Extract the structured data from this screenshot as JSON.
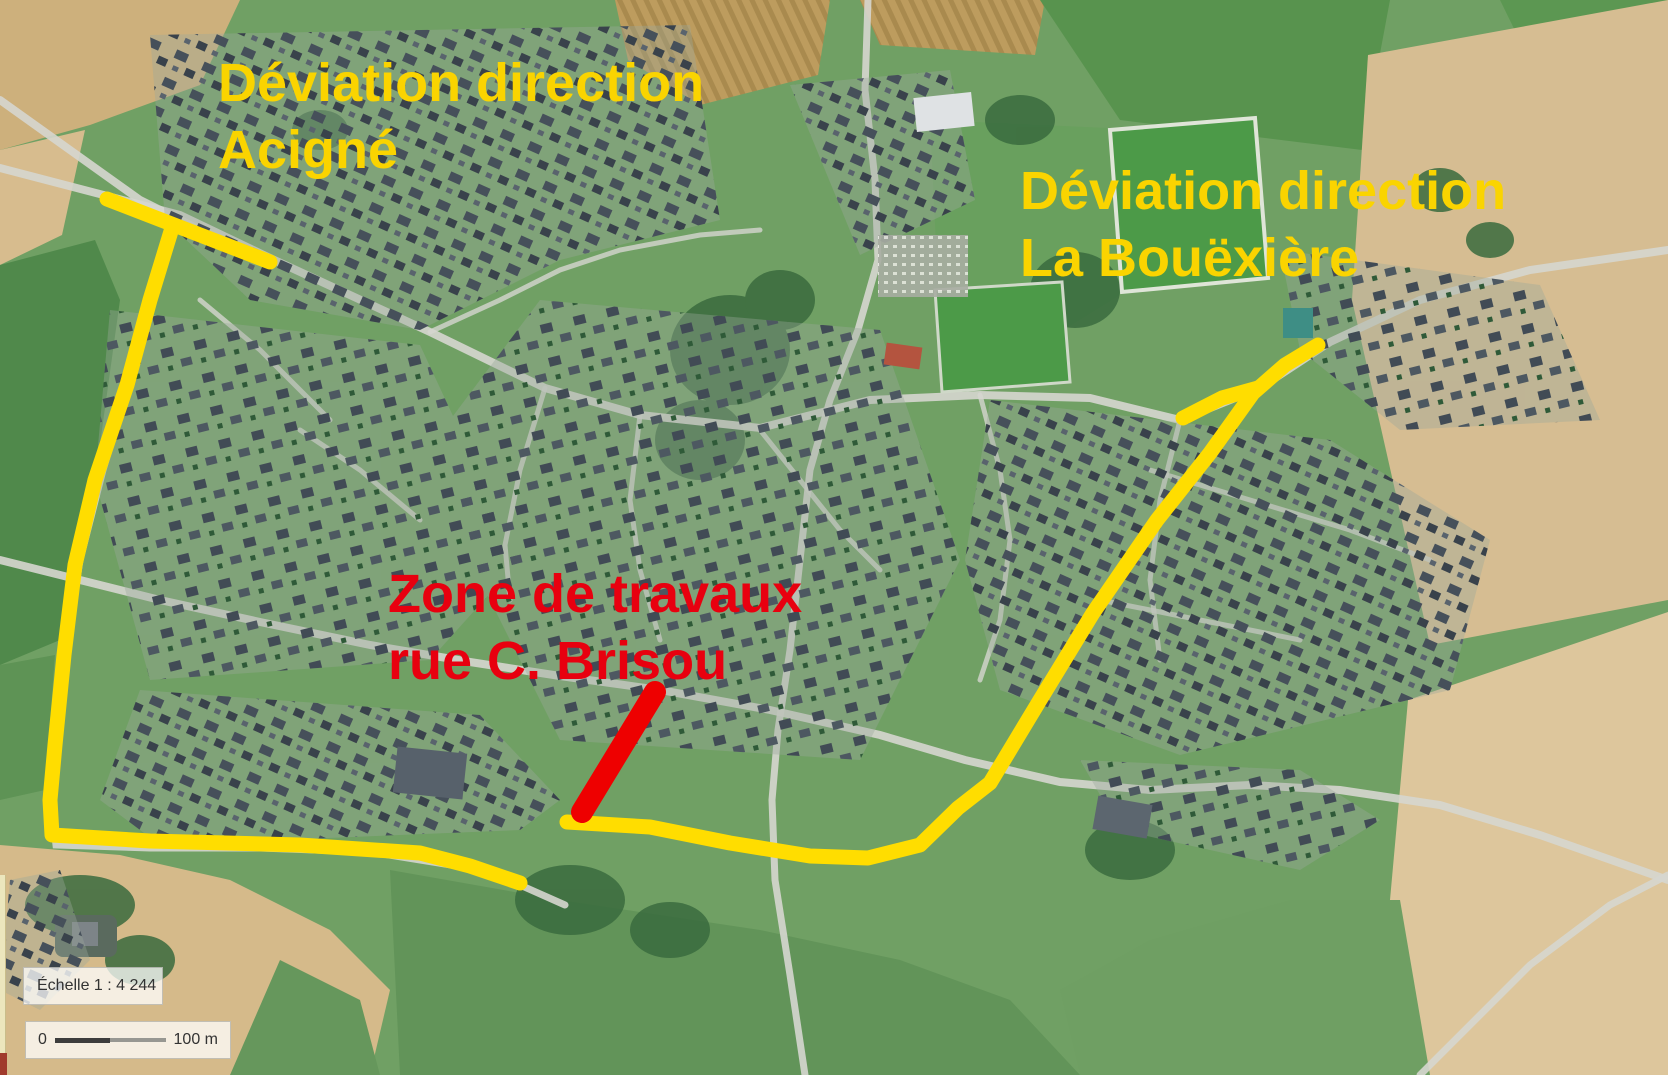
{
  "annotations": {
    "acigne": {
      "line1": "Déviation direction",
      "line2": "Acigné"
    },
    "bouexiere": {
      "line1": "Déviation direction",
      "line2": "La Bouëxière"
    },
    "travaux": {
      "line1": "Zone de travaux",
      "line2": "rue C. Brisou"
    }
  },
  "scale": {
    "echelle_label": "Échelle 1 :  4 244",
    "bar_start": "0",
    "bar_end": "100 m"
  },
  "colors": {
    "label_yellow": "#fad400",
    "label_red": "#e8000f",
    "route_yellow": "#ffdd00",
    "route_red": "#ee0000"
  },
  "routes": {
    "acigne_top_segment": {
      "points": "107,199 270,262",
      "kind": "yellow"
    },
    "west_route": {
      "points": "172,228 150,300 127,385 95,480 75,565 64,655 55,745 50,800 52,835 150,841 300,845 420,853 470,866 520,883",
      "kind": "yellow"
    },
    "east_route": {
      "points": "567,822 650,827 730,843 810,856 868,858 920,845 958,808 990,783 1040,700 1093,613 1157,520 1210,453 1253,393 1285,365 1318,345",
      "kind": "yellow"
    },
    "bouexiere_spur": {
      "points": "1183,418 1222,398 1258,388",
      "kind": "yellow"
    },
    "works_zone_segment": {
      "points": "582,812 655,692",
      "kind": "red"
    }
  },
  "route_style": {
    "yellow_width": 15,
    "red_width": 22
  }
}
